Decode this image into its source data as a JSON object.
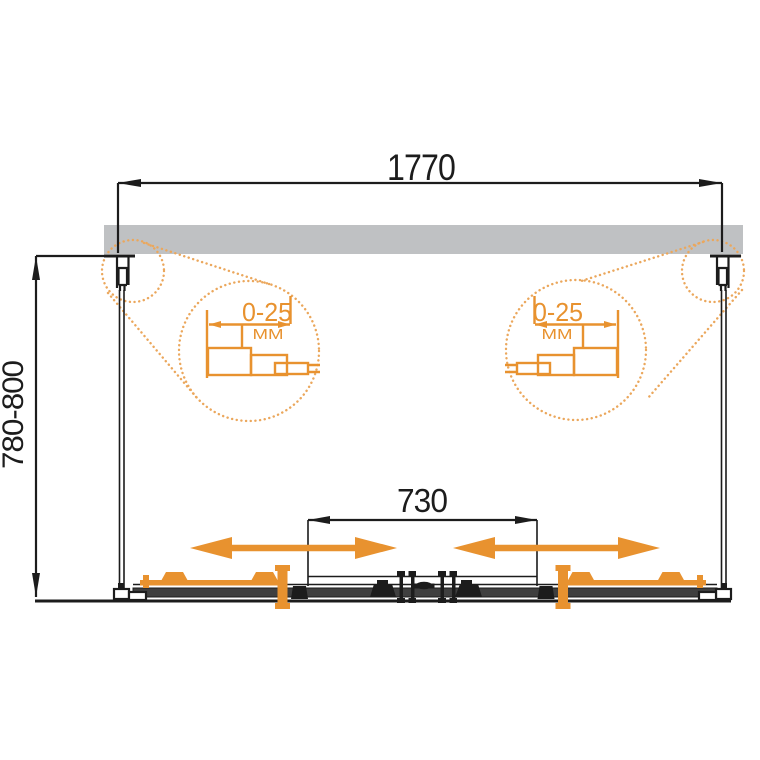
{
  "drawing": {
    "width_dim": "1770",
    "depth_dim": "780-800",
    "opening_dim": "730",
    "left_detail": {
      "range": "0-25",
      "unit": "MM"
    },
    "right_detail": {
      "range": "0-25",
      "unit": "MM"
    },
    "colors": {
      "ink": "#1c1c1c",
      "accent": "#E8922F",
      "accentLight": "#EBA75C",
      "wall": "#bfc1c3",
      "rail": "#3f3f3f",
      "bg": "#ffffff"
    }
  }
}
